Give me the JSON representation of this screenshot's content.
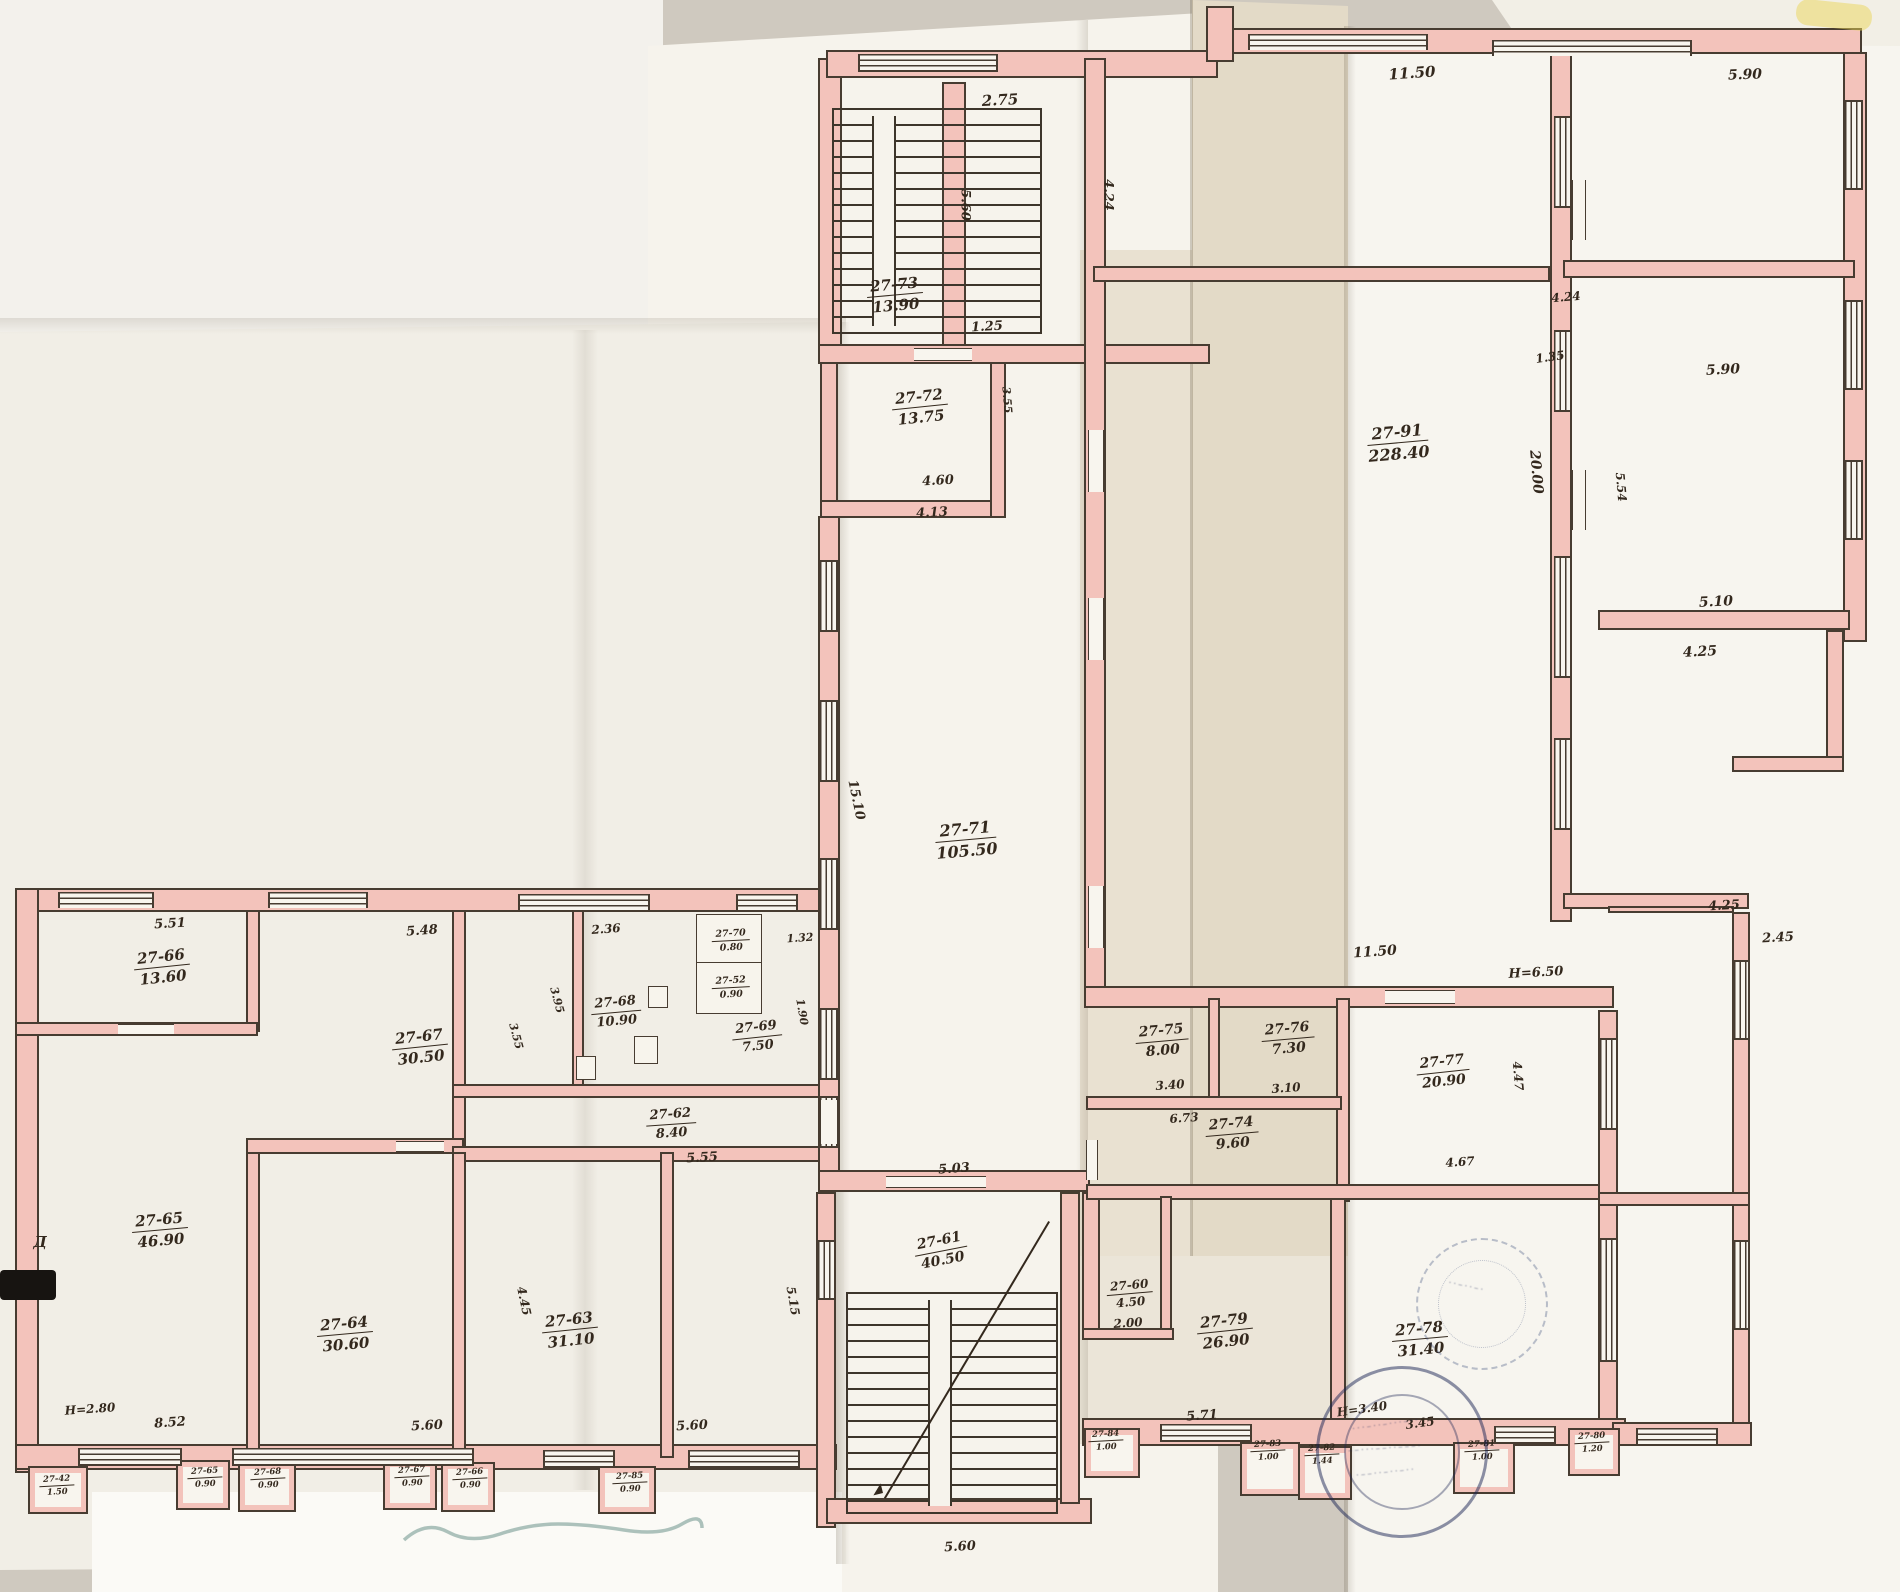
{
  "plan": {
    "rooms": [
      {
        "id": "r73",
        "number": "27-73",
        "area": "13.90"
      },
      {
        "id": "r72",
        "number": "27-72",
        "area": "13.75"
      },
      {
        "id": "r71",
        "number": "27-71",
        "area": "105.50"
      },
      {
        "id": "r91",
        "number": "27-91",
        "area": "228.40"
      },
      {
        "id": "r66",
        "number": "27-66",
        "area": "13.60"
      },
      {
        "id": "r67",
        "number": "27-67",
        "area": "30.50"
      },
      {
        "id": "r68",
        "number": "27-68",
        "area": "10.90"
      },
      {
        "id": "r70",
        "number": "27-70",
        "area": "0.80"
      },
      {
        "id": "r52",
        "number": "27-52",
        "area": "0.90"
      },
      {
        "id": "r69",
        "number": "27-69",
        "area": "7.50"
      },
      {
        "id": "r62",
        "number": "27-62",
        "area": "8.40"
      },
      {
        "id": "r65",
        "number": "27-65",
        "area": "46.90"
      },
      {
        "id": "r64",
        "number": "27-64",
        "area": "30.60"
      },
      {
        "id": "r63",
        "number": "27-63",
        "area": "31.10"
      },
      {
        "id": "r61",
        "number": "27-61",
        "area": "40.50"
      },
      {
        "id": "r60",
        "number": "27-60",
        "area": "4.50"
      },
      {
        "id": "r75",
        "number": "27-75",
        "area": "8.00"
      },
      {
        "id": "r76",
        "number": "27-76",
        "area": "7.30"
      },
      {
        "id": "r77",
        "number": "27-77",
        "area": "20.90"
      },
      {
        "id": "r74",
        "number": "27-74",
        "area": "9.60"
      },
      {
        "id": "r79",
        "number": "27-79",
        "area": "26.90"
      },
      {
        "id": "r78",
        "number": "27-78",
        "area": "31.40"
      },
      {
        "id": "b42",
        "number": "27-42",
        "area": "1.50"
      },
      {
        "id": "b65",
        "number": "27-65",
        "area": "0.90"
      },
      {
        "id": "b68",
        "number": "27-68",
        "area": "0.90"
      },
      {
        "id": "b67",
        "number": "27-67",
        "area": "0.90"
      },
      {
        "id": "b66",
        "number": "27-66",
        "area": "0.90"
      },
      {
        "id": "b85",
        "number": "27-85",
        "area": "0.90"
      },
      {
        "id": "b84",
        "number": "27-84",
        "area": "1.00"
      },
      {
        "id": "b83",
        "number": "27-83",
        "area": "1.00"
      },
      {
        "id": "b82",
        "number": "27-82",
        "area": "1.44"
      },
      {
        "id": "b81",
        "number": "27-81",
        "area": "1.00"
      },
      {
        "id": "b80",
        "number": "27-80",
        "area": "1.20"
      }
    ],
    "dims": [
      {
        "id": "d01",
        "text": "2.75"
      },
      {
        "id": "d02",
        "text": "11.50"
      },
      {
        "id": "d03",
        "text": "5.90"
      },
      {
        "id": "d04",
        "text": "5.60"
      },
      {
        "id": "d05",
        "text": "4.24"
      },
      {
        "id": "d06",
        "text": "1.25"
      },
      {
        "id": "d07",
        "text": "4.24"
      },
      {
        "id": "d08",
        "text": "1.35"
      },
      {
        "id": "d09",
        "text": "5.90"
      },
      {
        "id": "d10",
        "text": "20.00"
      },
      {
        "id": "d11",
        "text": "5.54"
      },
      {
        "id": "d12",
        "text": "3.55"
      },
      {
        "id": "d13",
        "text": "4.60"
      },
      {
        "id": "d14",
        "text": "4.13"
      },
      {
        "id": "d15",
        "text": "15.10"
      },
      {
        "id": "d16",
        "text": "11.50"
      },
      {
        "id": "d17",
        "text": "H=6.50"
      },
      {
        "id": "d18",
        "text": "5.10"
      },
      {
        "id": "d19",
        "text": "4.25"
      },
      {
        "id": "d20",
        "text": "4.25"
      },
      {
        "id": "d21",
        "text": "2.45"
      },
      {
        "id": "d22",
        "text": "5.51"
      },
      {
        "id": "d23",
        "text": "5.48"
      },
      {
        "id": "d24",
        "text": "2.36"
      },
      {
        "id": "d25",
        "text": "1.32"
      },
      {
        "id": "d26",
        "text": "1.90"
      },
      {
        "id": "d27",
        "text": "3.95"
      },
      {
        "id": "d28",
        "text": "3.55"
      },
      {
        "id": "d29",
        "text": "5.55"
      },
      {
        "id": "d30",
        "text": "5.03"
      },
      {
        "id": "d31",
        "text": "3.40"
      },
      {
        "id": "d32",
        "text": "3.10"
      },
      {
        "id": "d33",
        "text": "6.73"
      },
      {
        "id": "d34",
        "text": "4.67"
      },
      {
        "id": "d35",
        "text": "4.47"
      },
      {
        "id": "d36",
        "text": "4.45"
      },
      {
        "id": "d37",
        "text": "5.15"
      },
      {
        "id": "d38",
        "text": "8.52"
      },
      {
        "id": "d39",
        "text": "H=2.80"
      },
      {
        "id": "d40",
        "text": "5.60"
      },
      {
        "id": "d41",
        "text": "5.60"
      },
      {
        "id": "d42",
        "text": "5.71"
      },
      {
        "id": "d43",
        "text": "H=3.40"
      },
      {
        "id": "d44",
        "text": "3.45"
      },
      {
        "id": "d45",
        "text": "5.60"
      },
      {
        "id": "d46",
        "text": "2.00"
      },
      {
        "id": "d47",
        "text": "Д"
      }
    ]
  }
}
